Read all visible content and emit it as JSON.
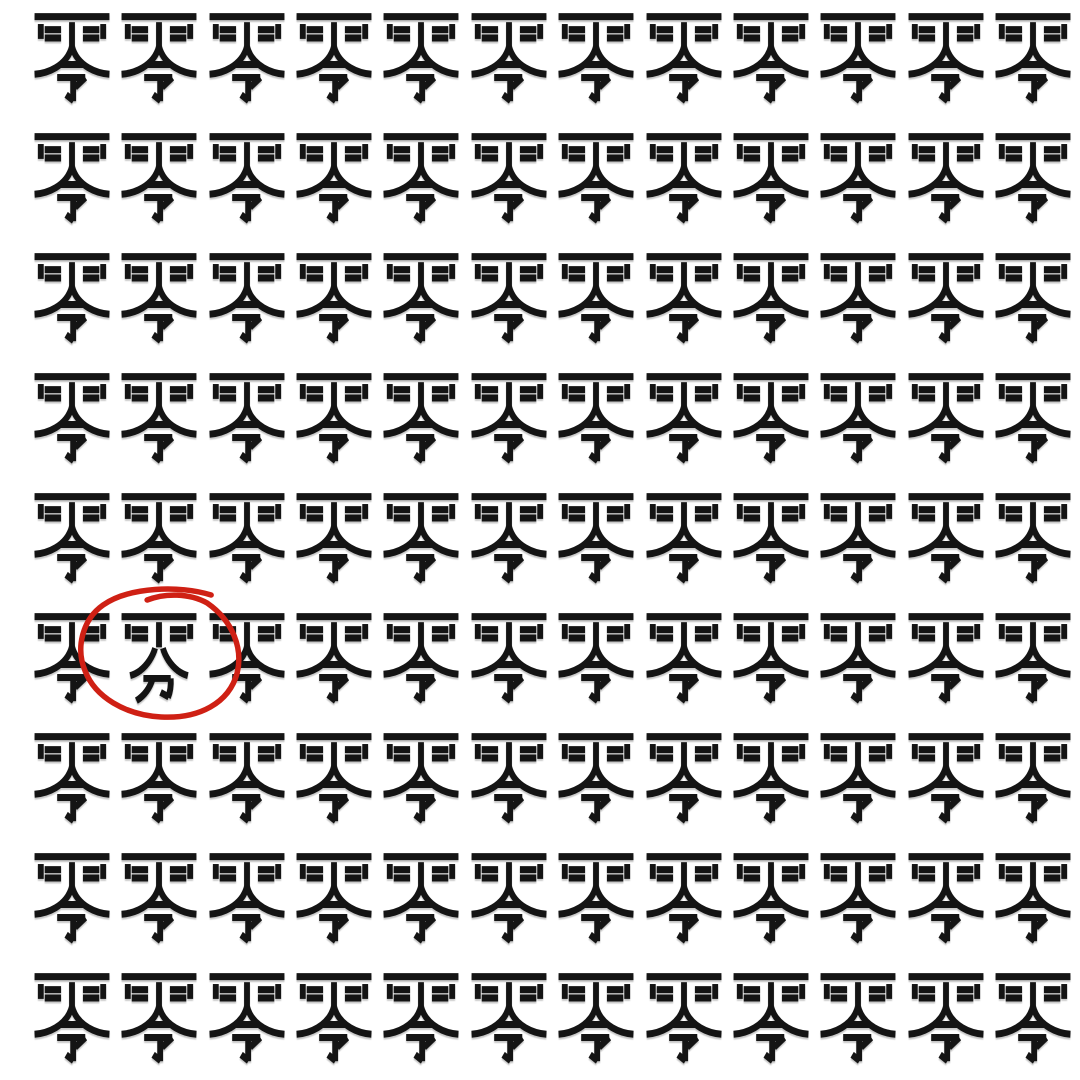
{
  "canvas": {
    "width": 1080,
    "height": 1080,
    "background": "#ffffff"
  },
  "grid": {
    "rows": 9,
    "cols": 12,
    "base_char": "零",
    "odd_char": "雰",
    "char_color": "#141414",
    "odd_position": {
      "row": 6,
      "col": 2
    }
  },
  "annotation": {
    "shape": "hand-drawn-ellipse",
    "color": "#cf2014",
    "stroke_width": 5.5,
    "circled_char": "雰",
    "circled_position": {
      "row": 6,
      "col": 2
    }
  }
}
